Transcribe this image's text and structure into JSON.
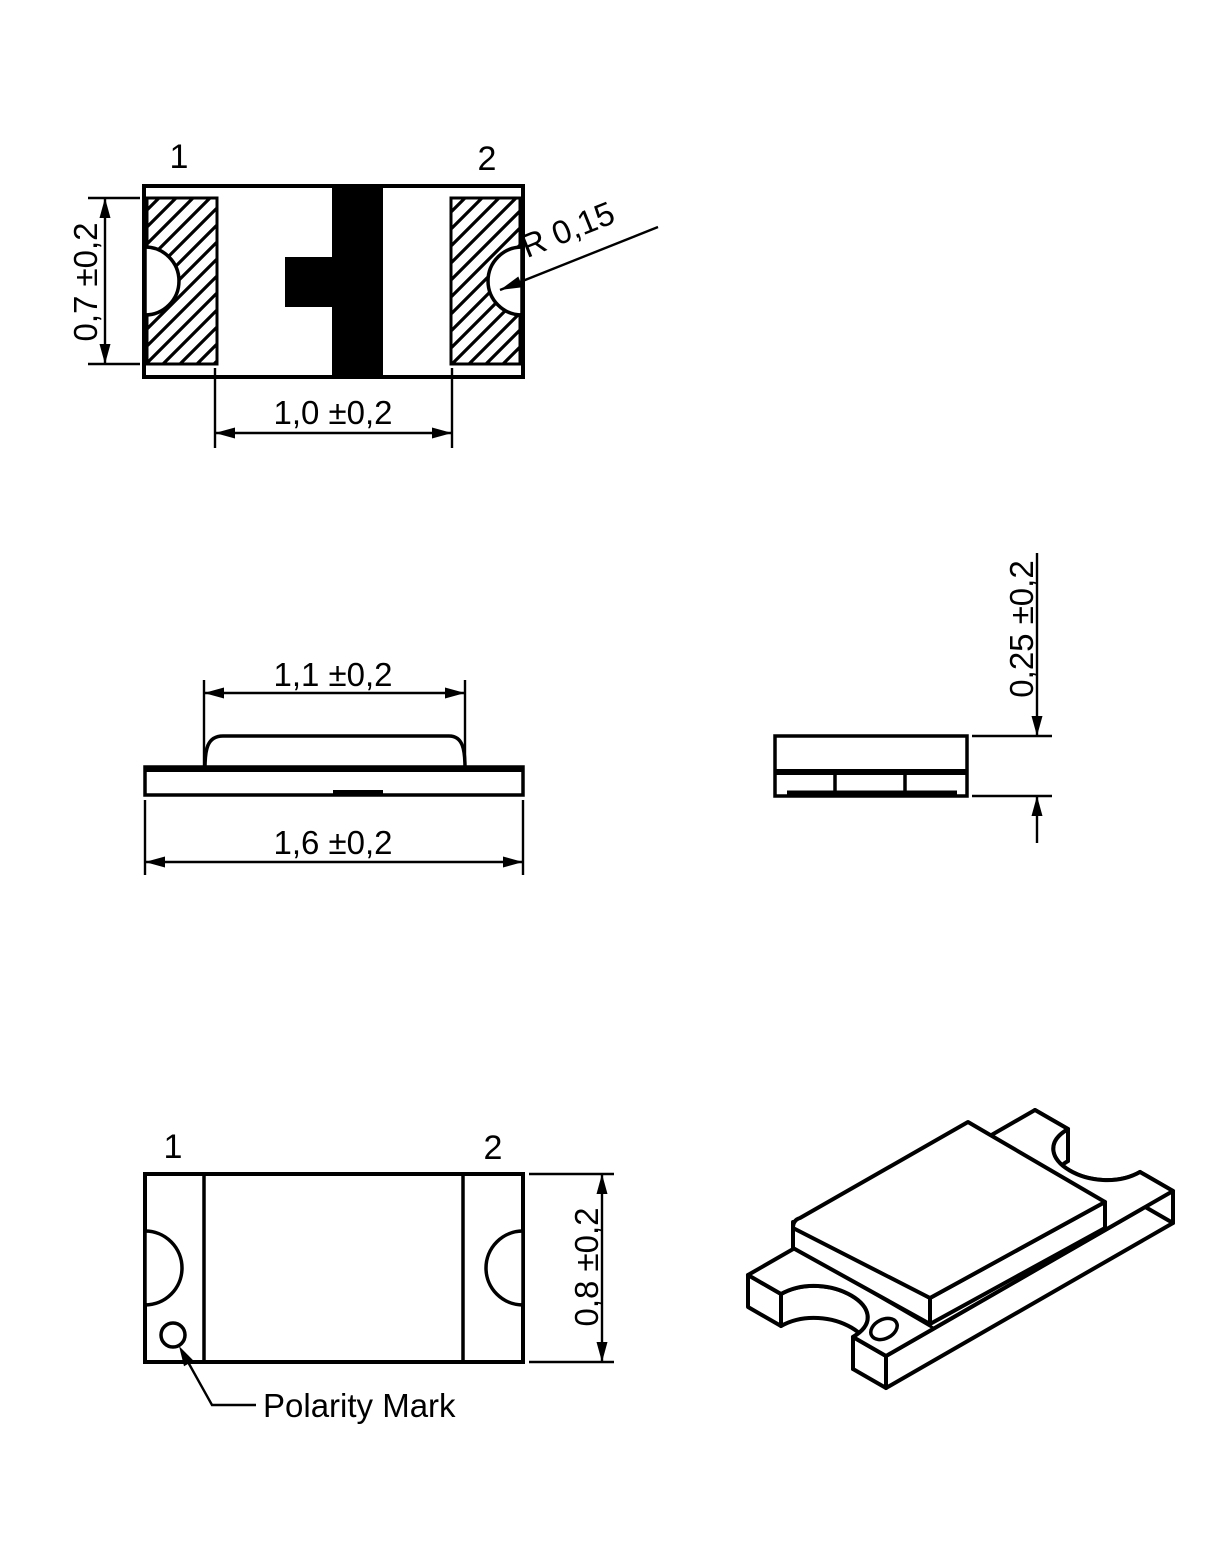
{
  "page": {
    "background": "#ffffff",
    "ink": "#000000"
  },
  "views": {
    "top": {
      "pin1_label": "1",
      "pin2_label": "2",
      "pad_height_dim": "0,7 ±0,2",
      "pad_gap_dim": "1,0 ±0,2",
      "notch_radius_dim": "R 0,15"
    },
    "side": {
      "lens_length_dim": "1,1 ±0,2",
      "body_length_dim": "1,6 ±0,2"
    },
    "end": {
      "thickness_dim": "0,25 ±0,2"
    },
    "bottom": {
      "pin1_label": "1",
      "pin2_label": "2",
      "body_width_dim": "0,8 ±0,2",
      "polarity_label": "Polarity Mark"
    }
  }
}
